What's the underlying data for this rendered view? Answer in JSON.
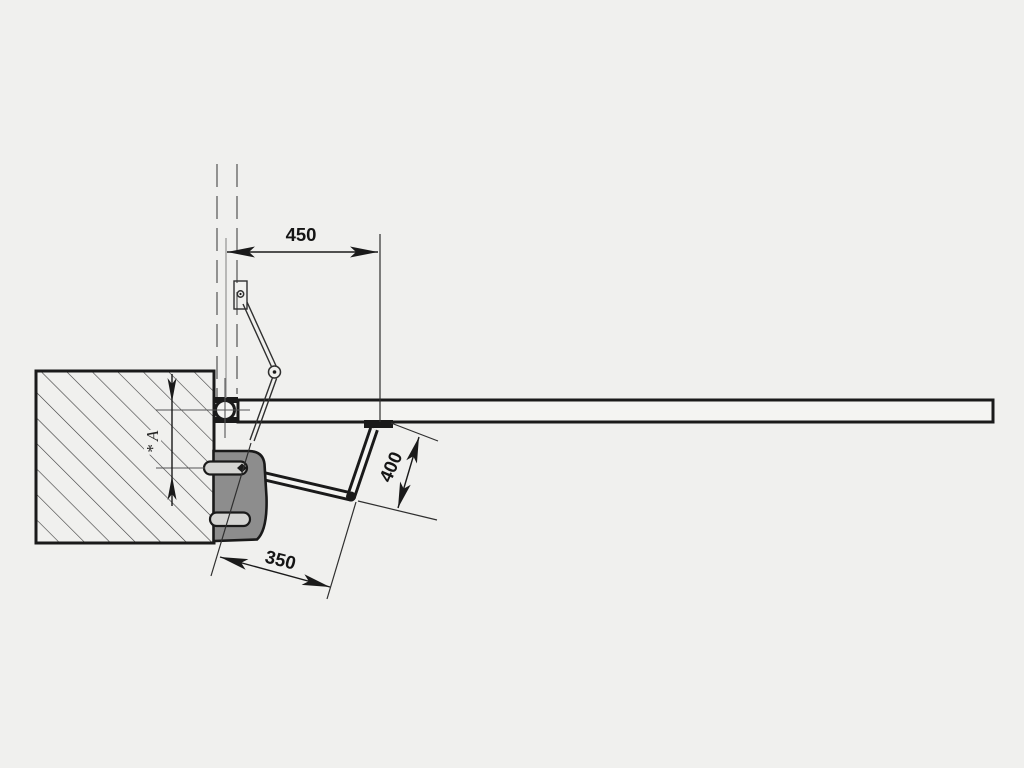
{
  "diagram": {
    "type": "technical-installation-drawing",
    "view": "plan-top-view-swing-gate-operator",
    "dimensions": [
      {
        "id": "hinge-to-bracket-distance",
        "label": "450"
      },
      {
        "id": "front-arm-segment-length",
        "label": "400"
      },
      {
        "id": "rear-arm-segment-length",
        "label": "350"
      },
      {
        "id": "post-offset-reference",
        "label": "* A"
      }
    ]
  },
  "colors": {
    "bg": "#f0f0ee",
    "line": "#1a1a1a",
    "hatch": "#3a3a3a",
    "gate": "#f4f4f2",
    "body": "#8d8d8d",
    "slot": "#d4d4d2",
    "center": "#8a8a8a",
    "axis": "#555555",
    "dash": "#5f5f5f",
    "thin": "#2f2f2f"
  }
}
